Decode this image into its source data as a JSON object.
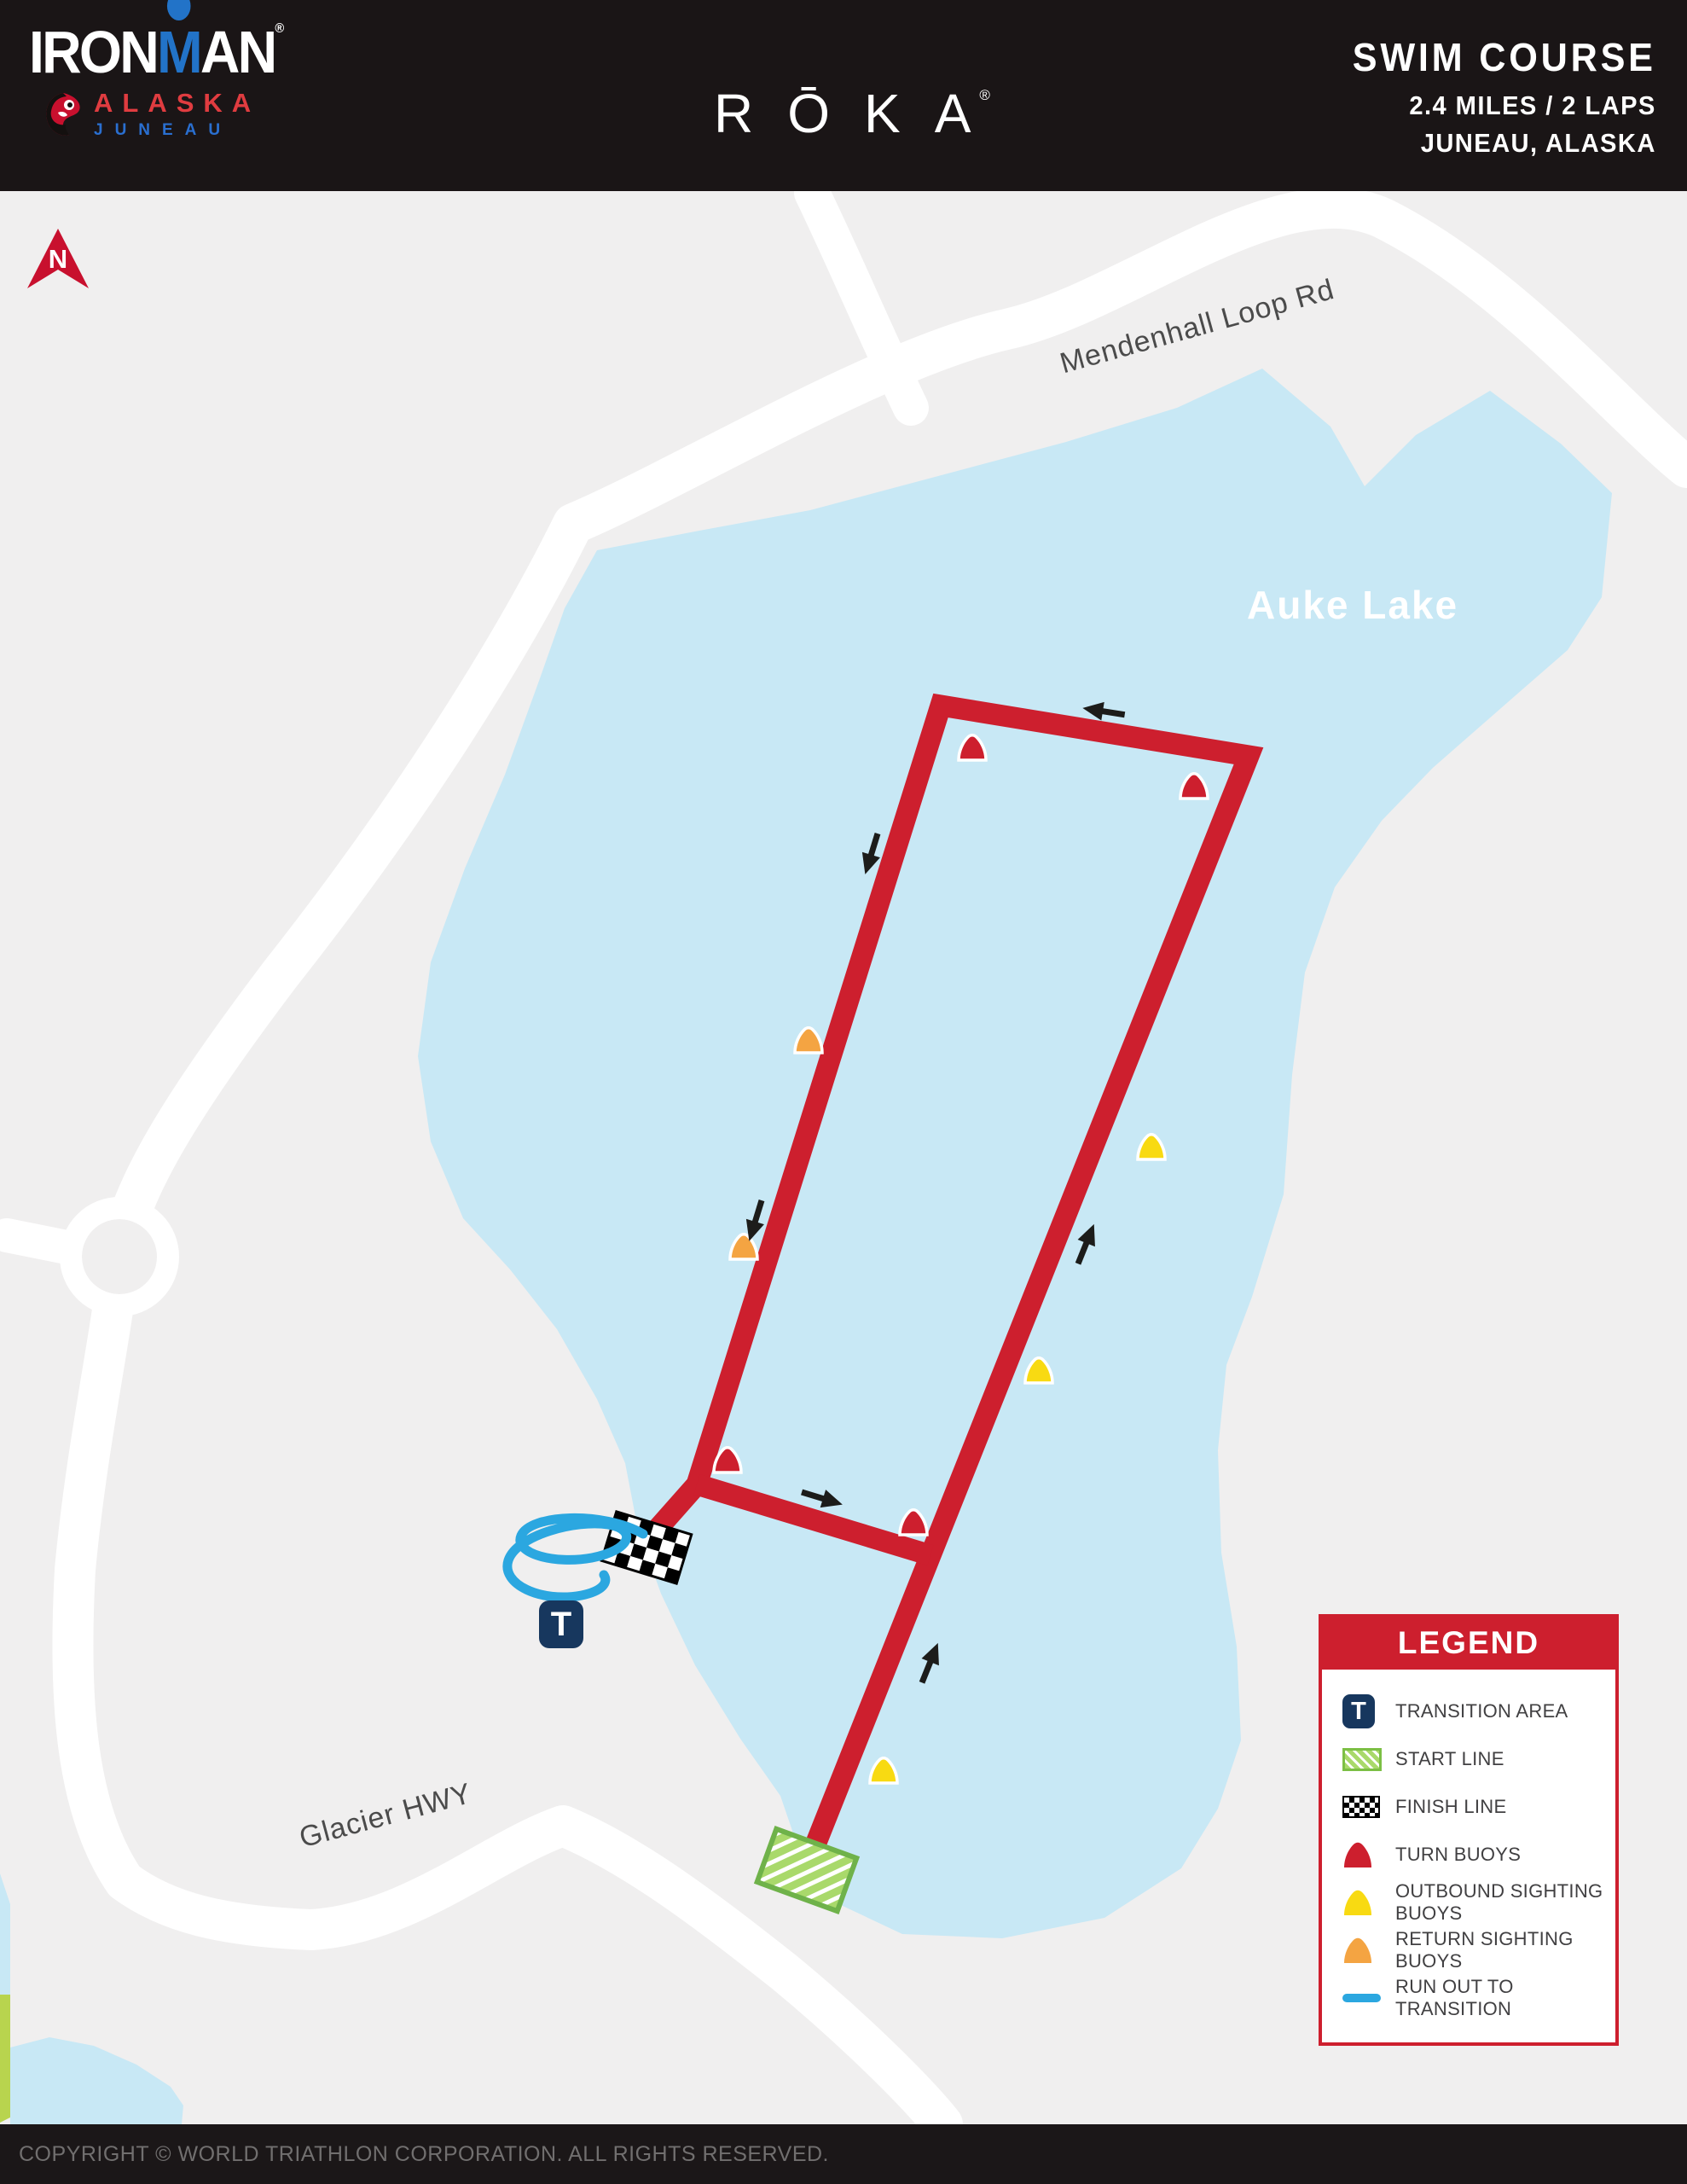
{
  "header": {
    "brand": "IRONMAN",
    "brand_reg": "®",
    "brand_region": "ALASKA",
    "brand_city": "JUNEAU",
    "sponsor": "RŌKA",
    "sponsor_reg": "®",
    "course_title": "SWIM COURSE",
    "course_stats": "2.4 MILES / 2 LAPS",
    "course_location": "JUNEAU, ALASKA"
  },
  "map": {
    "north_label": "N",
    "lake_label": "Auke Lake",
    "road_label_1": "Mendenhall Loop Rd",
    "road_label_2": "Glacier HWY",
    "transition_label": "T",
    "lap_direction": "counter-clockwise",
    "buoy_counts": {
      "turn": 4,
      "outbound_sighting": 3,
      "return_sighting": 2
    }
  },
  "legend": {
    "title": "LEGEND",
    "items": [
      {
        "icon": "transition-area-icon",
        "label": "TRANSITION AREA"
      },
      {
        "icon": "start-line-icon",
        "label": "START LINE"
      },
      {
        "icon": "finish-line-icon",
        "label": "FINISH LINE"
      },
      {
        "icon": "turn-buoy-icon",
        "label": "TURN BUOYS"
      },
      {
        "icon": "outbound-sighting-buoy-icon",
        "label": "OUTBOUND SIGHTING BUOYS"
      },
      {
        "icon": "return-sighting-buoy-icon",
        "label": "RETURN SIGHTING BUOYS"
      },
      {
        "icon": "run-out-icon",
        "label": "RUN OUT TO TRANSITION"
      }
    ]
  },
  "footer": {
    "copyright": "COPYRIGHT © WORLD TRIATHLON CORPORATION. ALL RIGHTS RESERVED."
  },
  "colors": {
    "course_red": "#cd1f2e",
    "lake_blue": "#c8e8f5",
    "land_gray": "#f0efef",
    "run_out_blue": "#2ba7e0",
    "transition_navy": "#17375e",
    "start_green": "#a9d96b",
    "outbound_yellow": "#f8da12",
    "return_orange": "#f4a442",
    "header_black": "#1a1516"
  }
}
